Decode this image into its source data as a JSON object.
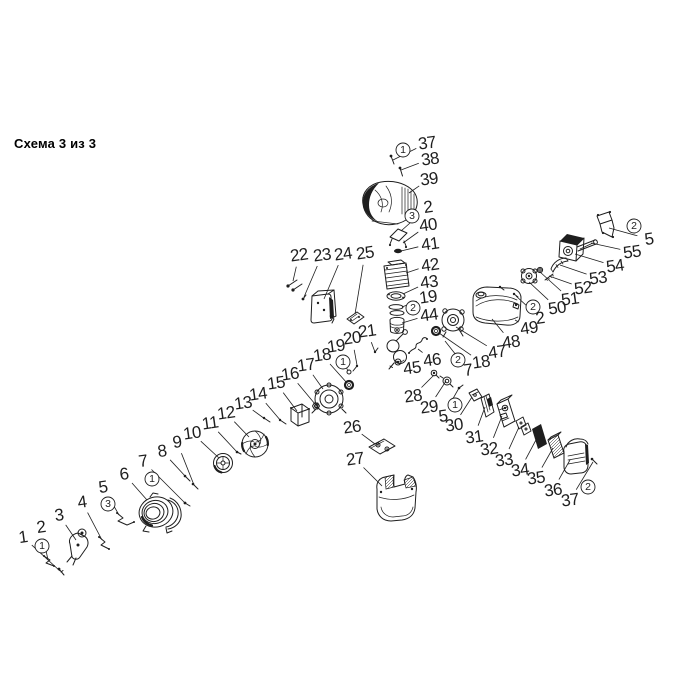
{
  "title": "Схема 3 из 3",
  "colors": {
    "ink": "#1e1e1e",
    "title": "#000000",
    "background": "#ffffff"
  },
  "diagram": {
    "labels": [
      {
        "t": "1",
        "x": 23,
        "y": 537,
        "lx": 60,
        "ly": 571
      },
      {
        "t": "2",
        "x": 41,
        "y": 527,
        "lx": 48,
        "ly": 560
      },
      {
        "t": "3",
        "x": 59,
        "y": 515,
        "lx": 76,
        "ly": 540
      },
      {
        "t": "4",
        "x": 82,
        "y": 502,
        "lx": 102,
        "ly": 540
      },
      {
        "t": "5",
        "x": 103,
        "y": 487,
        "lx": 119,
        "ly": 515
      },
      {
        "t": "6",
        "x": 124,
        "y": 474,
        "lx": 147,
        "ly": 500
      },
      {
        "t": "7",
        "x": 143,
        "y": 461,
        "lx": 185,
        "ly": 503
      },
      {
        "t": "8",
        "x": 162,
        "y": 451,
        "lx": 186,
        "ly": 477
      },
      {
        "t": "9",
        "x": 177,
        "y": 442,
        "lx": 194,
        "ly": 485
      },
      {
        "t": "10",
        "x": 192,
        "y": 433,
        "lx": 219,
        "ly": 458
      },
      {
        "t": "11",
        "x": 210,
        "y": 423,
        "lx": 237,
        "ly": 452
      },
      {
        "t": "12",
        "x": 226,
        "y": 413,
        "lx": 249,
        "ly": 437
      },
      {
        "t": "13",
        "x": 243,
        "y": 403,
        "lx": 265,
        "ly": 419
      },
      {
        "t": "14",
        "x": 258,
        "y": 394,
        "lx": 281,
        "ly": 421
      },
      {
        "t": "15",
        "x": 276,
        "y": 383,
        "lx": 297,
        "ly": 411
      },
      {
        "t": "16",
        "x": 290,
        "y": 374,
        "lx": 315,
        "ly": 404
      },
      {
        "t": "17",
        "x": 306,
        "y": 365,
        "lx": 323,
        "ly": 389
      },
      {
        "t": "18",
        "x": 322,
        "y": 355,
        "lx": 347,
        "ly": 383
      },
      {
        "t": "19",
        "x": 336,
        "y": 346,
        "lx": 348,
        "ly": 371
      },
      {
        "t": "20",
        "x": 352,
        "y": 338,
        "lx": 357,
        "ly": 365
      },
      {
        "t": "21",
        "x": 367,
        "y": 331,
        "lx": 375,
        "ly": 352
      },
      {
        "t": "22",
        "x": 299,
        "y": 255,
        "lx": 293,
        "ly": 281
      },
      {
        "t": "23",
        "x": 322,
        "y": 255,
        "lx": 304,
        "ly": 297
      },
      {
        "t": "24",
        "x": 343,
        "y": 254,
        "lx": 324,
        "ly": 299
      },
      {
        "t": "25",
        "x": 365,
        "y": 253,
        "lx": 355,
        "ly": 314
      },
      {
        "t": "37",
        "x": 427,
        "y": 143,
        "lx": 393,
        "ly": 160
      },
      {
        "t": "38",
        "x": 430,
        "y": 159,
        "lx": 401,
        "ly": 170
      },
      {
        "t": "39",
        "x": 429,
        "y": 179,
        "lx": 409,
        "ly": 193
      },
      {
        "t": "2",
        "x": 428,
        "y": 207,
        "lx": 401,
        "ly": 231
      },
      {
        "t": "40",
        "x": 428,
        "y": 225,
        "lx": 403,
        "ly": 243
      },
      {
        "t": "41",
        "x": 430,
        "y": 244,
        "lx": 401,
        "ly": 251
      },
      {
        "t": "42",
        "x": 430,
        "y": 265,
        "lx": 406,
        "ly": 273
      },
      {
        "t": "43",
        "x": 429,
        "y": 282,
        "lx": 403,
        "ly": 294
      },
      {
        "t": "19",
        "x": 428,
        "y": 297,
        "lx": 402,
        "ly": 307
      },
      {
        "t": "44",
        "x": 429,
        "y": 315,
        "lx": 402,
        "ly": 323
      },
      {
        "t": "45",
        "x": 412,
        "y": 368,
        "lx": 403,
        "ly": 360
      },
      {
        "t": "46",
        "x": 432,
        "y": 360,
        "lx": 418,
        "ly": 349
      },
      {
        "t": "26",
        "x": 352,
        "y": 427,
        "lx": 375,
        "ly": 444
      },
      {
        "t": "27",
        "x": 355,
        "y": 459,
        "lx": 382,
        "ly": 486
      },
      {
        "t": "7",
        "x": 468,
        "y": 370,
        "lx": 445,
        "ly": 341
      },
      {
        "t": "18",
        "x": 481,
        "y": 362,
        "lx": 439,
        "ly": 333
      },
      {
        "t": "47",
        "x": 497,
        "y": 352,
        "lx": 456,
        "ly": 327
      },
      {
        "t": "48",
        "x": 511,
        "y": 342,
        "lx": 492,
        "ly": 319
      },
      {
        "t": "28",
        "x": 413,
        "y": 396,
        "lx": 434,
        "ly": 375
      },
      {
        "t": "29",
        "x": 429,
        "y": 407,
        "lx": 446,
        "ly": 381
      },
      {
        "t": "5",
        "x": 443,
        "y": 416,
        "lx": 459,
        "ly": 388
      },
      {
        "t": "30",
        "x": 454,
        "y": 425,
        "lx": 472,
        "ly": 397
      },
      {
        "t": "31",
        "x": 474,
        "y": 437,
        "lx": 485,
        "ly": 407
      },
      {
        "t": "32",
        "x": 489,
        "y": 449,
        "lx": 502,
        "ly": 416
      },
      {
        "t": "33",
        "x": 504,
        "y": 460,
        "lx": 519,
        "ly": 427
      },
      {
        "t": "34",
        "x": 520,
        "y": 470,
        "lx": 537,
        "ly": 438
      },
      {
        "t": "35",
        "x": 536,
        "y": 478,
        "lx": 553,
        "ly": 448
      },
      {
        "t": "36",
        "x": 553,
        "y": 490,
        "lx": 570,
        "ly": 460
      },
      {
        "t": "37",
        "x": 570,
        "y": 500,
        "lx": 593,
        "ly": 462
      },
      {
        "t": "49",
        "x": 529,
        "y": 328,
        "lx": 515,
        "ly": 320
      },
      {
        "t": "2",
        "x": 540,
        "y": 318,
        "lx": 516,
        "ly": 296
      },
      {
        "t": "50",
        "x": 557,
        "y": 308,
        "lx": 529,
        "ly": 282
      },
      {
        "t": "51",
        "x": 570,
        "y": 299,
        "lx": 540,
        "ly": 272
      },
      {
        "t": "52",
        "x": 583,
        "y": 288,
        "lx": 549,
        "ly": 276
      },
      {
        "t": "53",
        "x": 598,
        "y": 278,
        "lx": 560,
        "ly": 265
      },
      {
        "t": "54",
        "x": 615,
        "y": 266,
        "lx": 575,
        "ly": 254
      },
      {
        "t": "55",
        "x": 632,
        "y": 252,
        "lx": 591,
        "ly": 243
      },
      {
        "t": "5",
        "x": 649,
        "y": 239,
        "lx": 609,
        "ly": 228
      }
    ],
    "badges": [
      {
        "t": "1",
        "x": 403,
        "y": 150
      },
      {
        "t": "3",
        "x": 412,
        "y": 216
      },
      {
        "t": "2",
        "x": 413,
        "y": 308
      },
      {
        "t": "1",
        "x": 343,
        "y": 362
      },
      {
        "t": "2",
        "x": 458,
        "y": 360
      },
      {
        "t": "2",
        "x": 533,
        "y": 307
      },
      {
        "t": "2",
        "x": 634,
        "y": 226
      },
      {
        "t": "1",
        "x": 455,
        "y": 405
      },
      {
        "t": "2",
        "x": 588,
        "y": 487
      },
      {
        "t": "1",
        "x": 152,
        "y": 479
      },
      {
        "t": "3",
        "x": 108,
        "y": 504
      },
      {
        "t": "1",
        "x": 42,
        "y": 546
      }
    ]
  }
}
